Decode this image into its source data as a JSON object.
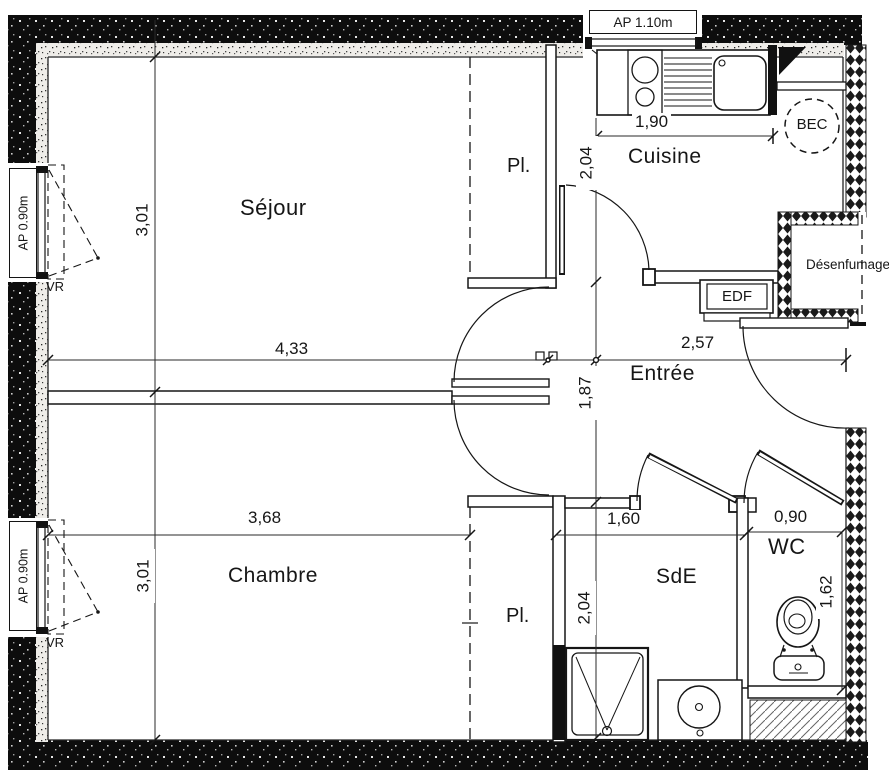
{
  "plan": {
    "rooms": {
      "sejour": "Séjour",
      "cuisine": "Cuisine",
      "chambre": "Chambre",
      "entree": "Entrée",
      "sde": "SdE",
      "wc": "WC"
    },
    "closets": {
      "top": "Pl.",
      "bottom": "Pl."
    },
    "labels": {
      "edf": "EDF",
      "bec": "BEC",
      "desenfumage": "Désenfumage"
    },
    "windows": {
      "kitchen": "AP 1.10m",
      "living": "AP 0.90m",
      "bedroom": "AP 0.90m",
      "shutter_living": "VR",
      "shutter_bedroom": "VR"
    },
    "dimensions": {
      "living_width": "4,33",
      "living_depth": "3,01",
      "bedroom_width": "3,68",
      "bedroom_depth": "3,01",
      "kitchen_width": "1,90",
      "kitchen_depth": "2,04",
      "hall_width": "2,57",
      "hall_depth": "1,87",
      "shower_room_width": "1,60",
      "shower_room_depth": "2,04",
      "wc_width": "0,90",
      "wc_depth": "1,62"
    },
    "colors": {
      "ink": "#161616",
      "wall": "#0d0d0d",
      "paper": "#ffffff"
    }
  }
}
